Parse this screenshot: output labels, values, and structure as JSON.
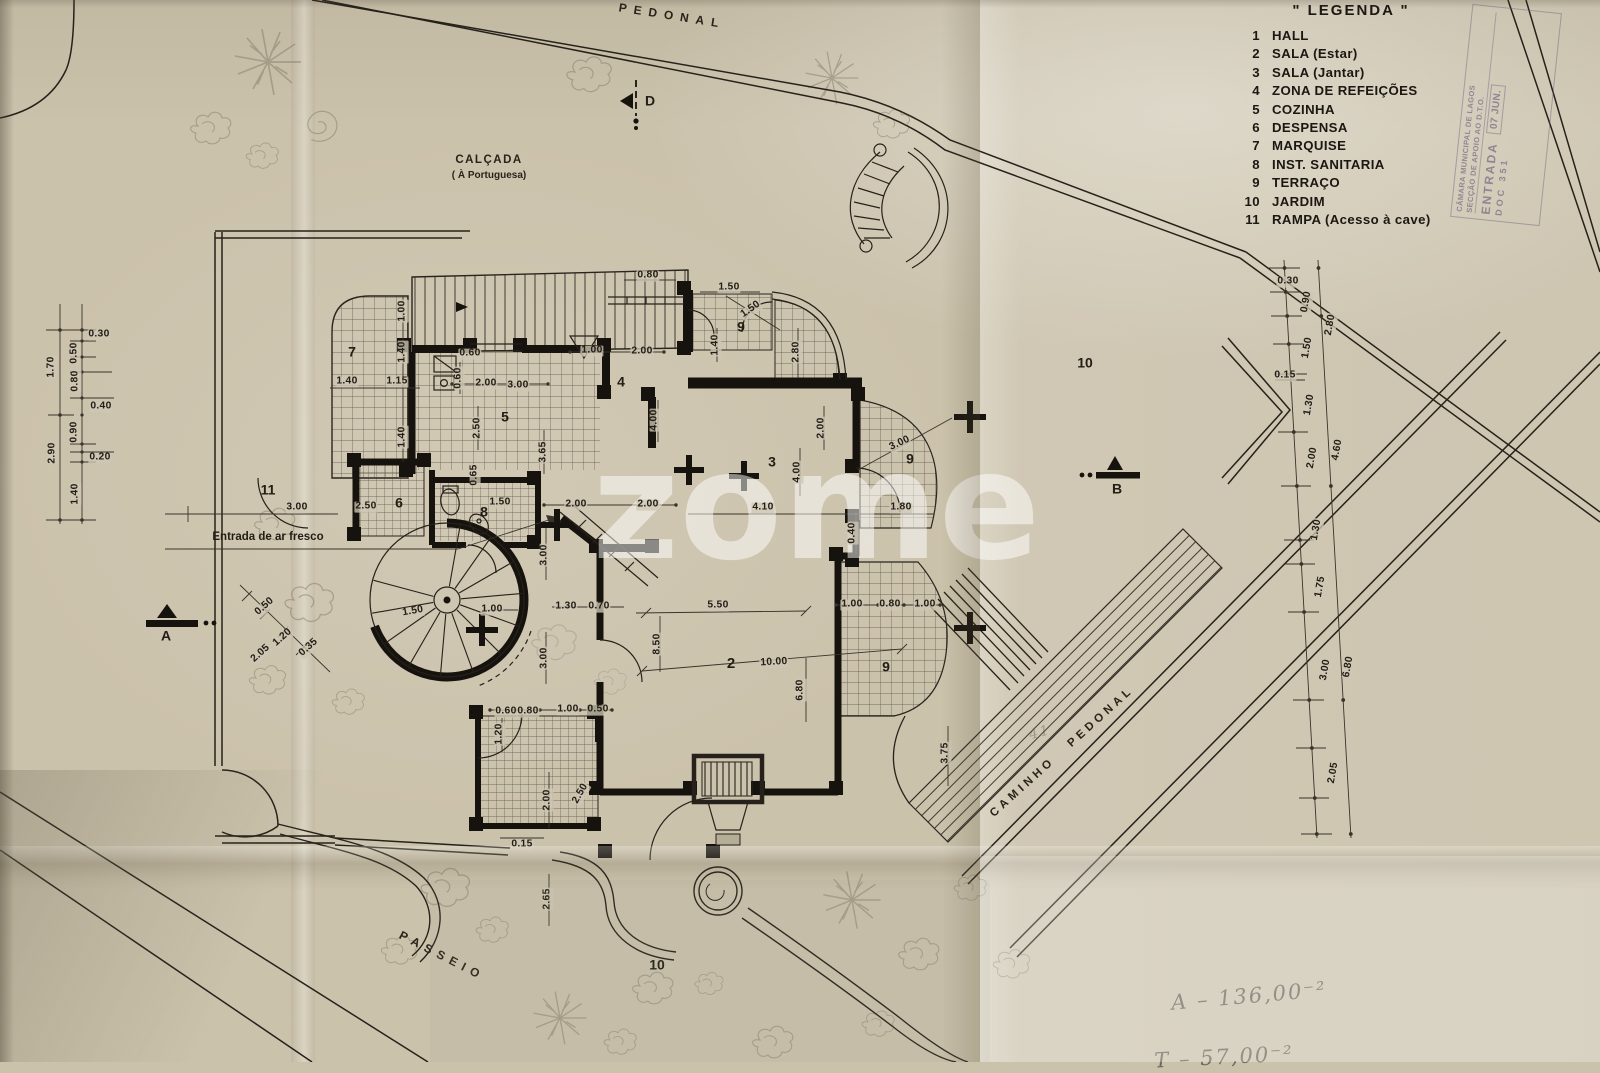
{
  "legend": {
    "title": "\" LEGENDA \"",
    "items": [
      {
        "num": "1",
        "label": "HALL"
      },
      {
        "num": "2",
        "label": "SALA (Estar)"
      },
      {
        "num": "3",
        "label": "SALA (Jantar)"
      },
      {
        "num": "4",
        "label": "ZONA DE REFEIÇÕES"
      },
      {
        "num": "5",
        "label": "COZINHA"
      },
      {
        "num": "6",
        "label": "DESPENSA"
      },
      {
        "num": "7",
        "label": "MARQUISE"
      },
      {
        "num": "8",
        "label": "INST. SANITARIA"
      },
      {
        "num": "9",
        "label": "TERRAÇO"
      },
      {
        "num": "10",
        "label": "JARDIM"
      },
      {
        "num": "11",
        "label": "RAMPA (Acesso à cave)"
      }
    ]
  },
  "stamp": {
    "org": "CÂMARA MUNICIPAL DE LAGOS",
    "dept": "SECÇÃO DE APOIO AO D.T.O.",
    "entry": "ENTRADA",
    "date": "07 JUN.",
    "number": "DOC 351"
  },
  "watermark": {
    "text": "zome"
  },
  "labels": [
    {
      "t": "PEDONAL",
      "x": 672,
      "y": 16,
      "r": 9,
      "s": 12,
      "sp": 7,
      "c": "road"
    },
    {
      "t": "CALÇADA",
      "x": 489,
      "y": 160,
      "s": 11.5,
      "sp": 1.5,
      "c": "road"
    },
    {
      "t": "( À Portuguesa)",
      "x": 489,
      "y": 176,
      "s": 10,
      "c": "road"
    },
    {
      "t": "PASSEIO",
      "x": 442,
      "y": 956,
      "r": 27,
      "s": 12,
      "sp": 6,
      "c": "road"
    },
    {
      "t": "CAMINHO   PEDONAL",
      "x": 1062,
      "y": 752,
      "r": -42,
      "s": 11.5,
      "sp": 4,
      "c": "road"
    },
    {
      "t": "Entrada de ar fresco",
      "x": 268,
      "y": 537,
      "c": "note"
    },
    {
      "t": "D",
      "x": 650,
      "y": 101,
      "c": "marker"
    },
    {
      "t": "A",
      "x": 166,
      "y": 636,
      "c": "marker"
    },
    {
      "t": "B",
      "x": 1117,
      "y": 489,
      "c": "marker"
    },
    {
      "t": "7",
      "x": 352,
      "y": 352,
      "c": "room"
    },
    {
      "t": "5",
      "x": 505,
      "y": 417,
      "c": "room"
    },
    {
      "t": "4",
      "x": 621,
      "y": 382,
      "c": "room"
    },
    {
      "t": "9",
      "x": 741,
      "y": 327,
      "c": "room"
    },
    {
      "t": "3",
      "x": 772,
      "y": 462,
      "c": "room"
    },
    {
      "t": "9",
      "x": 910,
      "y": 459,
      "c": "room"
    },
    {
      "t": "8",
      "x": 484,
      "y": 512,
      "c": "room"
    },
    {
      "t": "6",
      "x": 399,
      "y": 503,
      "c": "room"
    },
    {
      "t": "2",
      "x": 731,
      "y": 664,
      "s": 15,
      "c": "room"
    },
    {
      "t": "9",
      "x": 886,
      "y": 667,
      "c": "room"
    },
    {
      "t": "11",
      "x": 268,
      "y": 490,
      "c": "room"
    },
    {
      "t": "10",
      "x": 1085,
      "y": 363,
      "c": "room"
    },
    {
      "t": "10",
      "x": 657,
      "y": 965,
      "c": "room"
    },
    {
      "t": "0.30",
      "x": 99,
      "y": 335,
      "c": "dim"
    },
    {
      "t": "0.50",
      "x": 75,
      "y": 353,
      "r": -90,
      "c": "dim"
    },
    {
      "t": "0.80",
      "x": 76,
      "y": 381,
      "r": -90,
      "c": "dim"
    },
    {
      "t": "1.70",
      "x": 52,
      "y": 367,
      "r": -90,
      "c": "dim"
    },
    {
      "t": "0.40",
      "x": 101,
      "y": 407,
      "c": "dim"
    },
    {
      "t": "0.90",
      "x": 75,
      "y": 432,
      "r": -90,
      "c": "dim"
    },
    {
      "t": "0.20",
      "x": 100,
      "y": 458,
      "c": "dim"
    },
    {
      "t": "2.90",
      "x": 53,
      "y": 453,
      "r": -90,
      "c": "dim"
    },
    {
      "t": "1.40",
      "x": 76,
      "y": 494,
      "r": -90,
      "c": "dim"
    },
    {
      "t": "0.80",
      "x": 648,
      "y": 276,
      "c": "dim"
    },
    {
      "t": "1.50",
      "x": 729,
      "y": 288,
      "c": "dim"
    },
    {
      "t": "1.50",
      "x": 751,
      "y": 310,
      "r": -35,
      "c": "dim"
    },
    {
      "t": "1.40",
      "x": 716,
      "y": 345,
      "r": -90,
      "c": "dim"
    },
    {
      "t": "2.80",
      "x": 797,
      "y": 352,
      "r": -90,
      "c": "dim"
    },
    {
      "t": "1.00",
      "x": 592,
      "y": 351,
      "c": "dim"
    },
    {
      "t": "2.00",
      "x": 642,
      "y": 352,
      "c": "dim"
    },
    {
      "t": "0.60",
      "x": 470,
      "y": 354,
      "c": "dim"
    },
    {
      "t": "0.60",
      "x": 459,
      "y": 378,
      "r": -90,
      "c": "dim"
    },
    {
      "t": "2.00",
      "x": 486,
      "y": 384,
      "c": "dim"
    },
    {
      "t": "3.00",
      "x": 518,
      "y": 386,
      "c": "dim"
    },
    {
      "t": "1.00",
      "x": 403,
      "y": 311,
      "r": -90,
      "c": "dim"
    },
    {
      "t": "1.40",
      "x": 403,
      "y": 352,
      "r": -90,
      "c": "dim"
    },
    {
      "t": "1.40",
      "x": 347,
      "y": 382,
      "c": "dim"
    },
    {
      "t": "1.15",
      "x": 397,
      "y": 382,
      "c": "dim"
    },
    {
      "t": "1.40",
      "x": 403,
      "y": 437,
      "r": -90,
      "c": "dim"
    },
    {
      "t": "2.50",
      "x": 478,
      "y": 428,
      "r": -90,
      "c": "dim"
    },
    {
      "t": "3.65",
      "x": 544,
      "y": 452,
      "r": -90,
      "c": "dim"
    },
    {
      "t": "4.00",
      "x": 655,
      "y": 420,
      "r": -90,
      "c": "dim"
    },
    {
      "t": "4.00",
      "x": 798,
      "y": 472,
      "r": -90,
      "c": "dim"
    },
    {
      "t": "2.00",
      "x": 822,
      "y": 428,
      "r": -90,
      "c": "dim"
    },
    {
      "t": "3.00",
      "x": 900,
      "y": 444,
      "r": -25,
      "c": "dim"
    },
    {
      "t": "4.10",
      "x": 763,
      "y": 508,
      "c": "dim"
    },
    {
      "t": "1.80",
      "x": 901,
      "y": 508,
      "c": "dim"
    },
    {
      "t": "0.40",
      "x": 853,
      "y": 533,
      "r": -90,
      "c": "dim"
    },
    {
      "t": "2.50",
      "x": 366,
      "y": 507,
      "c": "dim"
    },
    {
      "t": "3.00",
      "x": 297,
      "y": 508,
      "c": "dim"
    },
    {
      "t": "1.50",
      "x": 500,
      "y": 503,
      "c": "dim"
    },
    {
      "t": "2.00",
      "x": 576,
      "y": 505,
      "c": "dim"
    },
    {
      "t": "2.00",
      "x": 648,
      "y": 505,
      "c": "dim"
    },
    {
      "t": "3.00",
      "x": 545,
      "y": 555,
      "r": -90,
      "c": "dim"
    },
    {
      "t": "3.00",
      "x": 545,
      "y": 658,
      "r": -90,
      "c": "dim"
    },
    {
      "t": "0.65",
      "x": 475,
      "y": 475,
      "r": -90,
      "c": "dim"
    },
    {
      "t": "1.50",
      "x": 413,
      "y": 612,
      "r": -10,
      "c": "dim"
    },
    {
      "t": "1.00",
      "x": 492,
      "y": 610,
      "c": "dim"
    },
    {
      "t": "1.30",
      "x": 566,
      "y": 607,
      "c": "dim"
    },
    {
      "t": "0.70",
      "x": 599,
      "y": 607,
      "c": "dim"
    },
    {
      "t": "5.50",
      "x": 718,
      "y": 606,
      "c": "dim"
    },
    {
      "t": "10.00",
      "x": 774,
      "y": 663,
      "r": -3,
      "c": "dim"
    },
    {
      "t": "8.50",
      "x": 658,
      "y": 644,
      "r": -90,
      "c": "dim"
    },
    {
      "t": "6.80",
      "x": 801,
      "y": 690,
      "r": -90,
      "c": "dim"
    },
    {
      "t": "1.00",
      "x": 852,
      "y": 605,
      "c": "dim"
    },
    {
      "t": "0.80",
      "x": 890,
      "y": 605,
      "c": "dim"
    },
    {
      "t": "1.00",
      "x": 925,
      "y": 605,
      "c": "dim"
    },
    {
      "t": "3.75",
      "x": 946,
      "y": 753,
      "r": -90,
      "c": "dim"
    },
    {
      "t": "0.50",
      "x": 265,
      "y": 607,
      "r": -42,
      "c": "dim"
    },
    {
      "t": "1.20",
      "x": 283,
      "y": 638,
      "r": -42,
      "c": "dim"
    },
    {
      "t": "2.05",
      "x": 261,
      "y": 654,
      "r": -42,
      "c": "dim"
    },
    {
      "t": "0.35",
      "x": 309,
      "y": 648,
      "r": -42,
      "c": "dim"
    },
    {
      "t": "0.60",
      "x": 506,
      "y": 712,
      "c": "dim"
    },
    {
      "t": "0.80",
      "x": 528,
      "y": 712,
      "c": "dim"
    },
    {
      "t": "1.00",
      "x": 568,
      "y": 710,
      "c": "dim"
    },
    {
      "t": "0.50",
      "x": 598,
      "y": 710,
      "c": "dim"
    },
    {
      "t": "1.20",
      "x": 500,
      "y": 734,
      "r": -90,
      "c": "dim"
    },
    {
      "t": "2.00",
      "x": 548,
      "y": 800,
      "r": -90,
      "c": "dim"
    },
    {
      "t": "2.50",
      "x": 581,
      "y": 794,
      "r": -60,
      "c": "dim"
    },
    {
      "t": "0.15",
      "x": 522,
      "y": 845,
      "c": "dim"
    },
    {
      "t": "2.65",
      "x": 548,
      "y": 899,
      "r": -90,
      "c": "dim"
    },
    {
      "t": "0.30",
      "x": 1288,
      "y": 282,
      "c": "dim"
    },
    {
      "t": "0.90",
      "x": 1307,
      "y": 302,
      "r": -80,
      "c": "dim"
    },
    {
      "t": "2.80",
      "x": 1331,
      "y": 325,
      "r": -80,
      "c": "dim"
    },
    {
      "t": "1.50",
      "x": 1308,
      "y": 348,
      "r": -80,
      "c": "dim"
    },
    {
      "t": "0.15",
      "x": 1285,
      "y": 376,
      "c": "dim"
    },
    {
      "t": "1.30",
      "x": 1310,
      "y": 405,
      "r": -80,
      "c": "dim"
    },
    {
      "t": "2.00",
      "x": 1313,
      "y": 458,
      "r": -80,
      "c": "dim"
    },
    {
      "t": "4.60",
      "x": 1338,
      "y": 450,
      "r": -80,
      "c": "dim"
    },
    {
      "t": "1.30",
      "x": 1317,
      "y": 530,
      "r": -80,
      "c": "dim"
    },
    {
      "t": "1.75",
      "x": 1321,
      "y": 587,
      "r": -80,
      "c": "dim"
    },
    {
      "t": "3.00",
      "x": 1326,
      "y": 670,
      "r": -80,
      "c": "dim"
    },
    {
      "t": "6.80",
      "x": 1349,
      "y": 667,
      "r": -80,
      "c": "dim"
    },
    {
      "t": "2.05",
      "x": 1334,
      "y": 773,
      "r": -80,
      "c": "dim"
    },
    {
      "t": "A – 136,00⁻²",
      "x": 1249,
      "y": 996,
      "r": -5,
      "s": 21,
      "c": "hand"
    },
    {
      "t": "T – 57,00⁻²",
      "x": 1224,
      "y": 1057,
      "r": -3,
      "s": 21,
      "c": "hand"
    },
    {
      "t": "41",
      "x": 1040,
      "y": 733,
      "r": -15,
      "s": 14,
      "o": 0.5,
      "c": "hand"
    }
  ]
}
